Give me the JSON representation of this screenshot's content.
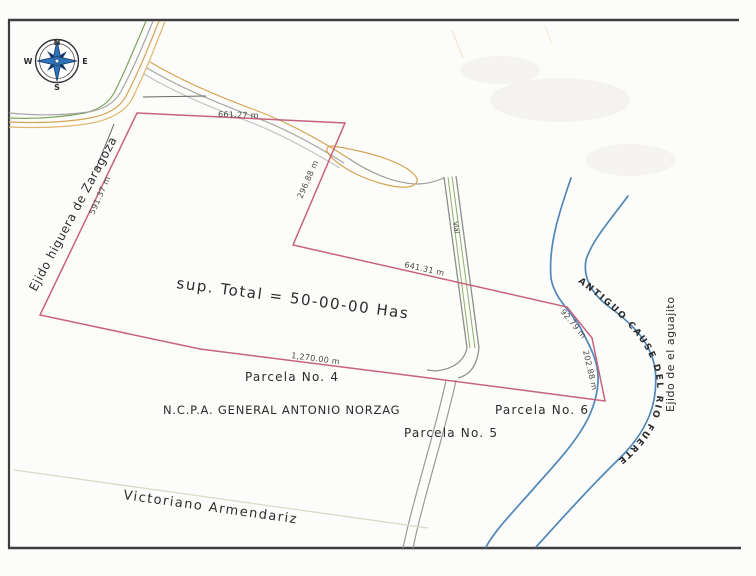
{
  "map": {
    "compass": {
      "n": "N",
      "e": "E",
      "s": "S",
      "w": "W"
    },
    "neighbors": {
      "west": "Ejido higuera de Zaragoza",
      "east": "Ejido de el aguajito",
      "south": "Victoriano Armendariz"
    },
    "area_note": "sup. Total = 50-00-00 Has",
    "owner": "N.C.P.A. GENERAL ANTONIO NORZAG",
    "parcels": {
      "p4": "Parcela No. 4",
      "p5": "Parcela No. 5",
      "p6": "Parcela No. 6"
    },
    "river_label": "ANTIGUO CAUSE DEL RIO FUERTE",
    "canal_label": "Vial",
    "dimensions": {
      "top": "661.27 m",
      "upper_right": "296.88 m",
      "west_side": "591.37 m",
      "middle": "641.31 m",
      "east_1": "92.79 m",
      "east_2": "202.88 m",
      "bottom": "1,270.00 m"
    },
    "colors": {
      "boundary": "#c8637c",
      "river": "#4f87b6",
      "river_text": "#d6404f",
      "road_orange": "#d5a455",
      "road_green": "#7ea65b",
      "road_gray": "#a6a6a6",
      "frame": "#3f3f3f"
    }
  }
}
